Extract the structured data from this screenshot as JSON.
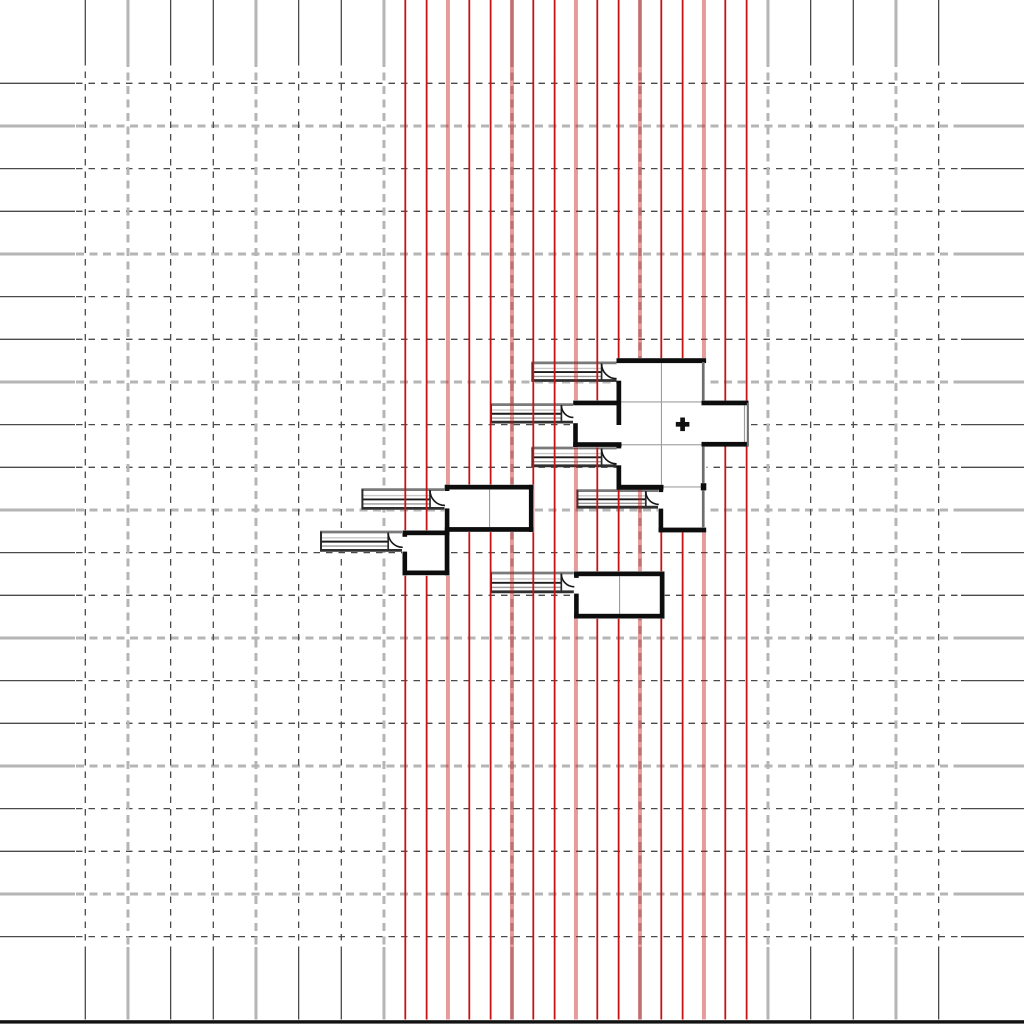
{
  "canvas": {
    "width": 1024,
    "height": 1024,
    "background": "#ffffff"
  },
  "grid": {
    "cell": 42.667,
    "x0": 85.3,
    "y0": 83.3,
    "cols": 21,
    "rows": 21,
    "light_modulo": 3,
    "light_offset": 1,
    "v_solid_top_end": 59,
    "v_dash_end": 947,
    "v_bottom_end": 1019.5,
    "h_solid_left_end": 75,
    "h_dash_start": 76,
    "h_dash_end": 961,
    "dark_color": "#4a4a4a",
    "dark_width": 1.3,
    "dark_dash": "6.5 6",
    "light_color": "#b5b5b5",
    "light_width": 3,
    "light_dash": "8 5.5"
  },
  "red_lines": {
    "x0": 405.3,
    "spacing": 21.333,
    "count": 17,
    "y1": 0,
    "y2": 1019.5,
    "thin_color": "#c51414",
    "thin_width": 1.8,
    "thick_color": "rgba(197,20,20,0.42)",
    "thick_width": 4,
    "thick_modulo": 3,
    "thick_offset": 2
  },
  "bottom_bar": {
    "x": 0,
    "y": 1020.2,
    "w": 1024,
    "h": 3.4,
    "color": "#121212"
  },
  "plan": {
    "wall_color": "#0d0d0d",
    "thin_wall_color": "#6e6e6e",
    "interior_line_color": "#9c9c9c",
    "corridor": {
      "top_border_color": "#7a7a7a",
      "bottom_border_color": "#303030",
      "border_width": 2.8,
      "stripe_colors": [
        "#c8c8c8",
        "#1c1c1c",
        "#9a9a9a"
      ],
      "stripe_widths": [
        1.4,
        1.9,
        1.4
      ],
      "stripe_fracs": [
        0.34,
        0.52,
        0.73
      ],
      "cap_color": "#2a2a2a",
      "door_line_color": "#151515"
    },
    "fills": [
      [
        616.5,
        358.0,
        90.0,
        130.8
      ],
      [
        701.0,
        400.5,
        47.8,
        46.0
      ],
      [
        658.0,
        486.0,
        48.5,
        46.5
      ],
      [
        573.0,
        400.3,
        48.5,
        47.0
      ],
      [
        444.5,
        484.5,
        89.5,
        47.6
      ],
      [
        402.0,
        530.2,
        48.0,
        45.6
      ],
      [
        573.8,
        571.2,
        91.0,
        47.6
      ]
    ],
    "walls": [
      [
        616.5,
        358.2,
        89.6,
        4.9
      ],
      [
        616.5,
        380.7,
        4.7,
        44.3
      ],
      [
        616.5,
        443.0,
        4.7,
        5.4
      ],
      [
        616.5,
        465.3,
        4.7,
        21.8
      ],
      [
        616.5,
        484.8,
        47.0,
        4.9
      ],
      [
        658.6,
        486.9,
        4.6,
        5.2
      ],
      [
        658.6,
        508.6,
        4.6,
        23.7
      ],
      [
        658.6,
        527.6,
        47.6,
        4.8
      ],
      [
        701.5,
        400.6,
        47.0,
        4.7
      ],
      [
        701.5,
        441.9,
        47.0,
        4.7
      ],
      [
        700.8,
        483.2,
        5.5,
        7.2
      ],
      [
        573.2,
        400.6,
        44.0,
        4.7
      ],
      [
        573.2,
        423.2,
        4.6,
        23.8
      ],
      [
        573.2,
        442.2,
        48.3,
        4.7
      ],
      [
        444.8,
        484.8,
        88.8,
        4.7
      ],
      [
        528.9,
        484.8,
        4.6,
        47.1
      ],
      [
        444.8,
        527.1,
        88.8,
        4.7
      ],
      [
        444.8,
        484.8,
        4.6,
        6.2
      ],
      [
        444.8,
        508.4,
        4.6,
        23.5
      ],
      [
        402.5,
        530.5,
        47.0,
        4.7
      ],
      [
        444.7,
        530.5,
        4.7,
        44.8
      ],
      [
        402.5,
        570.5,
        47.0,
        4.7
      ],
      [
        402.5,
        530.5,
        4.6,
        6.3
      ],
      [
        402.5,
        551.6,
        4.6,
        23.7
      ],
      [
        574.1,
        571.5,
        90.4,
        4.7
      ],
      [
        659.8,
        571.5,
        4.7,
        47.1
      ],
      [
        574.1,
        613.8,
        90.4,
        4.7
      ],
      [
        574.1,
        571.5,
        4.6,
        6.4
      ],
      [
        574.1,
        593.6,
        4.6,
        25.0
      ]
    ],
    "thin_walls": [
      [
        701.9,
        362.0,
        2.7,
        38.8
      ],
      [
        701.9,
        446.4,
        2.7,
        37.0
      ],
      [
        701.9,
        490.2,
        2.7,
        37.8
      ],
      [
        746.8,
        402.8,
        2.1,
        43.6
      ]
    ],
    "interior_lines": [
      [
        660.9,
        363.2,
        1.1,
        121.5
      ],
      [
        621.2,
        401.4,
        80.5,
        1.1
      ],
      [
        621.2,
        444.2,
        80.5,
        1.1
      ],
      [
        663.4,
        486.4,
        38.0,
        1.1
      ],
      [
        489.0,
        489.6,
        1.1,
        37.6
      ],
      [
        619.0,
        576.3,
        1.1,
        37.5
      ],
      [
        743.9,
        405.4,
        1.2,
        37.2
      ]
    ],
    "corridors": [
      {
        "x": 531.4,
        "y": 361.5,
        "w": 85.2,
        "h": 20.4,
        "door_w": 15.0
      },
      {
        "x": 490.0,
        "y": 403.2,
        "w": 83.4,
        "h": 20.3,
        "door_w": 12.0
      },
      {
        "x": 531.4,
        "y": 446.6,
        "w": 85.2,
        "h": 20.6,
        "door_w": 15.0
      },
      {
        "x": 576.4,
        "y": 489.2,
        "w": 82.4,
        "h": 19.4,
        "door_w": 13.0
      },
      {
        "x": 361.4,
        "y": 488.2,
        "w": 83.6,
        "h": 21.6,
        "door_w": 15.0
      },
      {
        "x": 320.0,
        "y": 530.6,
        "w": 82.7,
        "h": 21.2,
        "door_w": 14.5
      },
      {
        "x": 490.0,
        "y": 571.6,
        "w": 84.3,
        "h": 21.6,
        "door_w": 13.0
      }
    ],
    "marker": {
      "cx": 682.6,
      "cy": 424.3,
      "arm": 6.8,
      "stroke": 4.7,
      "color": "#111111"
    }
  }
}
